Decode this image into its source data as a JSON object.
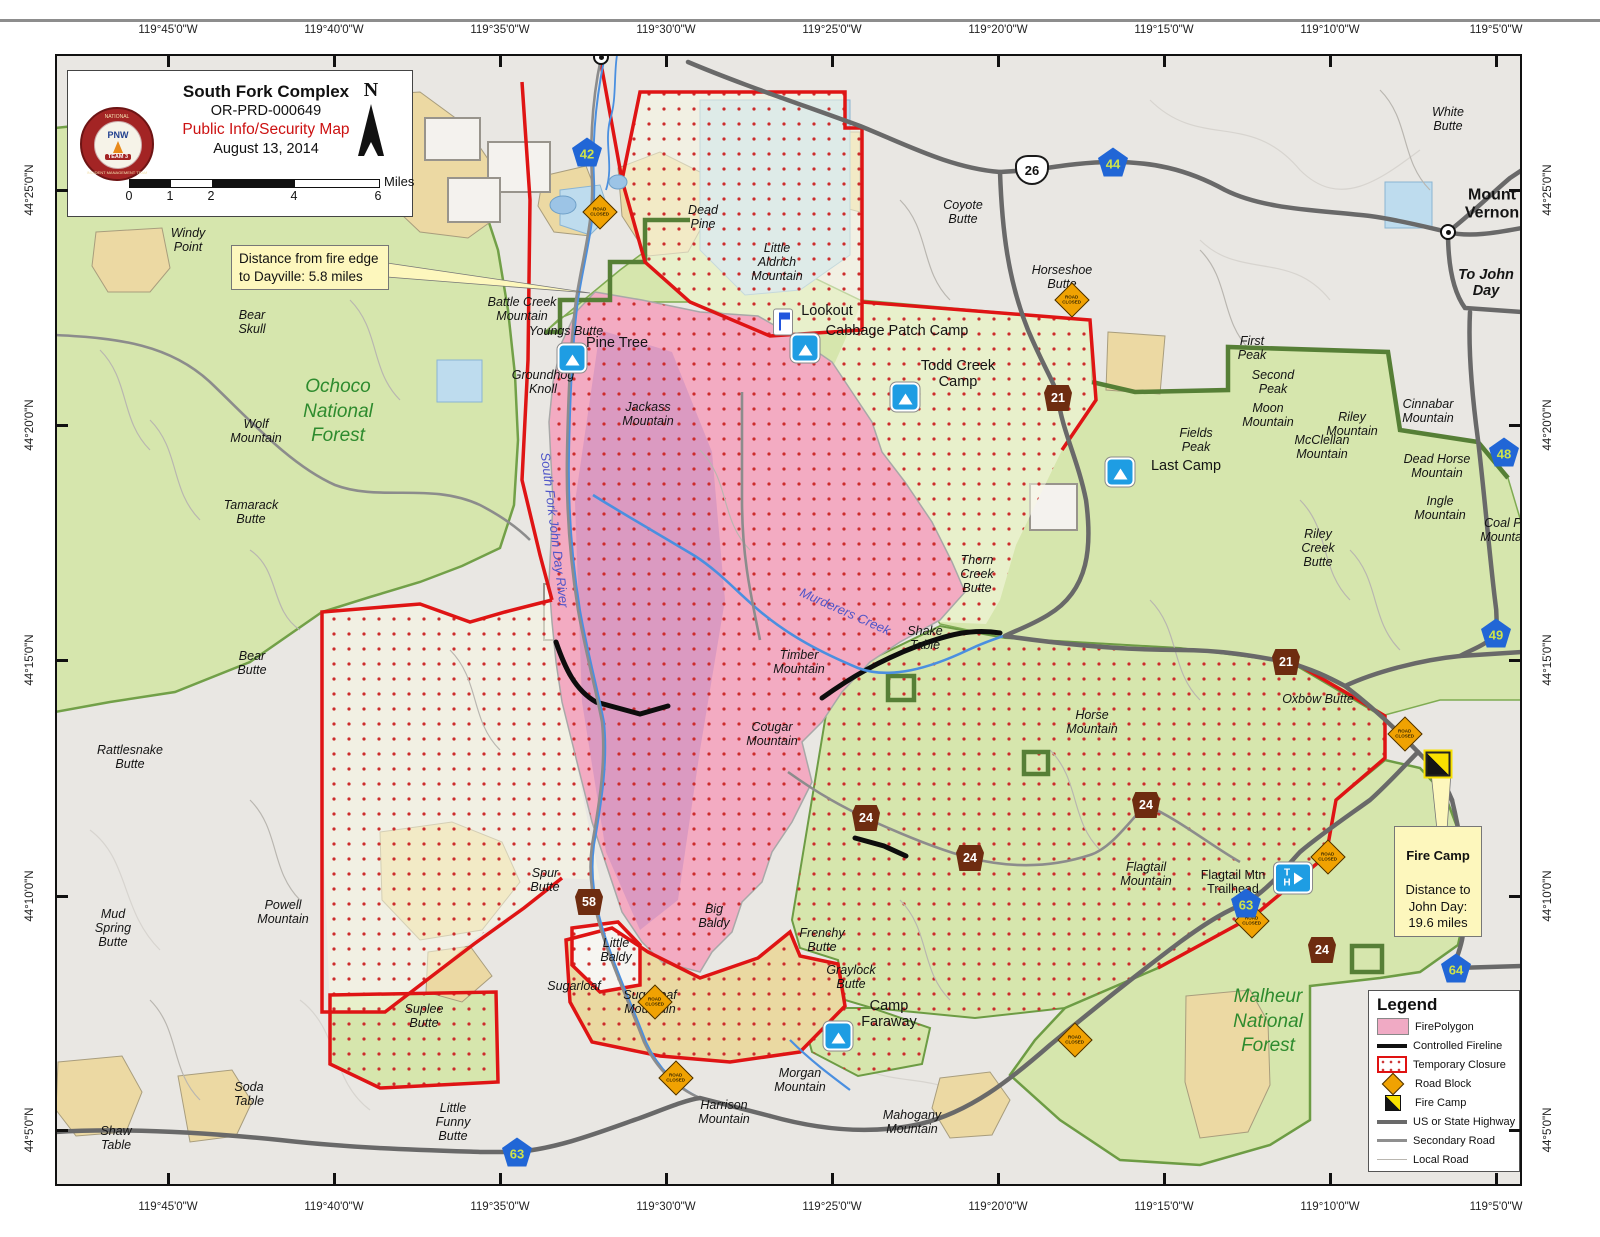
{
  "title_block": {
    "incident_name": "South Fork Complex",
    "incident_number": "OR-PRD-000649",
    "map_type": "Public Info/Security Map",
    "date": "August 13, 2014",
    "north_label": "N",
    "scale_units": "Miles",
    "scale_ticks": [
      "0",
      "1",
      "2",
      "4",
      "6"
    ],
    "logo": {
      "ring_top": "NATIONAL",
      "ring_bottom": "INCIDENT MANAGEMENT TEAM",
      "center": "PNW",
      "banner": "TEAM 3"
    }
  },
  "callouts": {
    "dayville": "Distance from fire edge\nto Dayville:  5.8 miles",
    "fire_camp_title": "Fire Camp",
    "fire_camp_body": "Distance to\nJohn Day:\n19.6 miles"
  },
  "legend": {
    "title": "Legend",
    "items": [
      "FirePolygon",
      "Controlled Fireline",
      "Temporary Closure",
      "Road Block",
      "Fire Camp",
      "US or State Highway",
      "Secondary Road",
      "Local Road"
    ]
  },
  "icon_text": {
    "trailhead": "T\nH",
    "roadblock": "ROAD\nCLOSED"
  },
  "colors": {
    "fire_polygon": "#f3abc2",
    "closure_border": "#e01212",
    "forest_green": "#d6e6ad",
    "highway_blue_shield": "#2166d6",
    "forest_route_brown": "#6e2c10",
    "callout_yellow": "#fdf7bd"
  },
  "coordinates": {
    "top": [
      {
        "t": "119°45'0\"W",
        "x": 168
      },
      {
        "t": "119°40'0\"W",
        "x": 334
      },
      {
        "t": "119°35'0\"W",
        "x": 500
      },
      {
        "t": "119°30'0\"W",
        "x": 666
      },
      {
        "t": "119°25'0\"W",
        "x": 832
      },
      {
        "t": "119°20'0\"W",
        "x": 998
      },
      {
        "t": "119°15'0\"W",
        "x": 1164
      },
      {
        "t": "119°10'0\"W",
        "x": 1330
      },
      {
        "t": "119°5'0\"W",
        "x": 1496
      }
    ],
    "bottom": [
      {
        "t": "119°45'0\"W",
        "x": 168
      },
      {
        "t": "119°40'0\"W",
        "x": 334
      },
      {
        "t": "119°35'0\"W",
        "x": 500
      },
      {
        "t": "119°30'0\"W",
        "x": 666
      },
      {
        "t": "119°25'0\"W",
        "x": 832
      },
      {
        "t": "119°20'0\"W",
        "x": 998
      },
      {
        "t": "119°15'0\"W",
        "x": 1164
      },
      {
        "t": "119°10'0\"W",
        "x": 1330
      },
      {
        "t": "119°5'0\"W",
        "x": 1496
      }
    ],
    "left": [
      {
        "t": "44°25'0\"N",
        "y": 190
      },
      {
        "t": "44°20'0\"N",
        "y": 425
      },
      {
        "t": "44°15'0\"N",
        "y": 660
      },
      {
        "t": "44°10'0\"N",
        "y": 896
      },
      {
        "t": "44°5'0\"N",
        "y": 1130
      }
    ],
    "right": [
      {
        "t": "44°25'0\"N",
        "y": 190
      },
      {
        "t": "44°20'0\"N",
        "y": 425
      },
      {
        "t": "44°15'0\"N",
        "y": 660
      },
      {
        "t": "44°10'0\"N",
        "y": 896
      },
      {
        "t": "44°5'0\"N",
        "y": 1130
      }
    ]
  },
  "map": {
    "labels": [
      {
        "t": "White\nButte",
        "x": 1448,
        "y": 119,
        "cls": "place"
      },
      {
        "t": "Mount\nVernon",
        "x": 1492,
        "y": 204,
        "cls": "town"
      },
      {
        "t": "To John\nDay",
        "x": 1486,
        "y": 283,
        "cls": "town-it"
      },
      {
        "t": "Coyote\nButte",
        "x": 963,
        "y": 212,
        "cls": "place"
      },
      {
        "t": "Horseshoe\nButte",
        "x": 1062,
        "y": 277,
        "cls": "place"
      },
      {
        "t": "Windy\nPoint",
        "x": 188,
        "y": 240,
        "cls": "place"
      },
      {
        "t": "Bear\nSkull",
        "x": 252,
        "y": 322,
        "cls": "place"
      },
      {
        "t": "Battle Creek\nMountain",
        "x": 522,
        "y": 309,
        "cls": "place"
      },
      {
        "t": "Youngs Butte",
        "x": 566,
        "y": 331,
        "cls": "place"
      },
      {
        "t": "Pine Tree",
        "x": 617,
        "y": 343,
        "cls": "camp"
      },
      {
        "t": "Groundhog\nKnoll",
        "x": 543,
        "y": 382,
        "cls": "place"
      },
      {
        "t": "Ochoco\nNational\nForest",
        "x": 338,
        "y": 412,
        "cls": "forest"
      },
      {
        "t": "Wolf\nMountain",
        "x": 256,
        "y": 431,
        "cls": "place"
      },
      {
        "t": "Tamarack\nButte",
        "x": 251,
        "y": 512,
        "cls": "place"
      },
      {
        "t": "Dead\nPine",
        "x": 703,
        "y": 217,
        "cls": "place"
      },
      {
        "t": "Little\nAldrich\nMountain",
        "x": 777,
        "y": 262,
        "cls": "place"
      },
      {
        "t": "Lookout",
        "x": 827,
        "y": 311,
        "cls": "camp"
      },
      {
        "t": "Cabbage Patch Camp",
        "x": 897,
        "y": 331,
        "cls": "camp"
      },
      {
        "t": "Todd Creek\nCamp",
        "x": 958,
        "y": 374,
        "cls": "camp"
      },
      {
        "t": "Jackass\nMountain",
        "x": 648,
        "y": 414,
        "cls": "place"
      },
      {
        "t": "First\nPeak",
        "x": 1252,
        "y": 348,
        "cls": "place"
      },
      {
        "t": "Second\nPeak",
        "x": 1273,
        "y": 382,
        "cls": "place"
      },
      {
        "t": "Moon\nMountain",
        "x": 1268,
        "y": 415,
        "cls": "place"
      },
      {
        "t": "Fields\nPeak",
        "x": 1196,
        "y": 440,
        "cls": "place"
      },
      {
        "t": "Last Camp",
        "x": 1186,
        "y": 466,
        "cls": "camp"
      },
      {
        "t": "Riley\nMountain",
        "x": 1352,
        "y": 424,
        "cls": "place"
      },
      {
        "t": "Cinnabar\nMountain",
        "x": 1428,
        "y": 411,
        "cls": "place"
      },
      {
        "t": "McClellan\nMountain",
        "x": 1322,
        "y": 447,
        "cls": "place"
      },
      {
        "t": "Dead Horse\nMountain",
        "x": 1437,
        "y": 466,
        "cls": "place"
      },
      {
        "t": "Ingle\nMountain",
        "x": 1440,
        "y": 508,
        "cls": "place"
      },
      {
        "t": "Coal Pit\nMountain",
        "x": 1506,
        "y": 530,
        "cls": "place"
      },
      {
        "t": "Riley\nCreek\nButte",
        "x": 1318,
        "y": 548,
        "cls": "place"
      },
      {
        "t": "Thorn\nCreek\nButte",
        "x": 977,
        "y": 574,
        "cls": "place"
      },
      {
        "t": "Shake\nTable",
        "x": 925,
        "y": 638,
        "cls": "place"
      },
      {
        "t": "Timber\nMountain",
        "x": 799,
        "y": 662,
        "cls": "place"
      },
      {
        "t": "Cougar\nMountain",
        "x": 772,
        "y": 734,
        "cls": "place"
      },
      {
        "t": "Bear\nButte",
        "x": 252,
        "y": 663,
        "cls": "place"
      },
      {
        "t": "Rattlesnake\nButte",
        "x": 130,
        "y": 757,
        "cls": "place"
      },
      {
        "t": "Horse\nMountain",
        "x": 1092,
        "y": 722,
        "cls": "place"
      },
      {
        "t": "Oxbow Butte",
        "x": 1318,
        "y": 699,
        "cls": "place"
      },
      {
        "t": "Mud\nSpring\nButte",
        "x": 113,
        "y": 928,
        "cls": "place"
      },
      {
        "t": "Powell\nMountain",
        "x": 283,
        "y": 912,
        "cls": "place"
      },
      {
        "t": "Spur\nButte",
        "x": 545,
        "y": 880,
        "cls": "place"
      },
      {
        "t": "Big\nBaldy",
        "x": 714,
        "y": 916,
        "cls": "place"
      },
      {
        "t": "Little\nBaldy",
        "x": 616,
        "y": 950,
        "cls": "place"
      },
      {
        "t": "Sugarloaf",
        "x": 574,
        "y": 986,
        "cls": "place"
      },
      {
        "t": "Sugarloaf\nMountain",
        "x": 650,
        "y": 1002,
        "cls": "place"
      },
      {
        "t": "Frenchy\nButte",
        "x": 822,
        "y": 940,
        "cls": "place"
      },
      {
        "t": "Graylock\nButte",
        "x": 851,
        "y": 977,
        "cls": "place"
      },
      {
        "t": "Camp\nFaraway",
        "x": 889,
        "y": 1014,
        "cls": "camp"
      },
      {
        "t": "Flagtail\nMountain",
        "x": 1146,
        "y": 874,
        "cls": "place"
      },
      {
        "t": "Flagtail Mtn\nTrailhead",
        "x": 1233,
        "y": 882,
        "cls": "plain"
      },
      {
        "t": "Malheur\nNational\nForest",
        "x": 1268,
        "y": 1022,
        "cls": "forest"
      },
      {
        "t": "Suplee\nButte",
        "x": 424,
        "y": 1016,
        "cls": "place"
      },
      {
        "t": "Soda\nTable",
        "x": 249,
        "y": 1094,
        "cls": "place"
      },
      {
        "t": "Shaw\nTable",
        "x": 116,
        "y": 1138,
        "cls": "place"
      },
      {
        "t": "Little\nFunny\nButte",
        "x": 453,
        "y": 1122,
        "cls": "place"
      },
      {
        "t": "Morgan\nMountain",
        "x": 800,
        "y": 1080,
        "cls": "place"
      },
      {
        "t": "Harrison\nMountain",
        "x": 724,
        "y": 1112,
        "cls": "place"
      },
      {
        "t": "Mahogany\nMountain",
        "x": 912,
        "y": 1122,
        "cls": "place"
      },
      {
        "t": "Murderers Creek",
        "x": 845,
        "y": 612,
        "cls": "creek",
        "rot": 24
      },
      {
        "t": "South Fork John Day River",
        "x": 554,
        "y": 530,
        "cls": "creek",
        "rot": 83
      }
    ],
    "shields": [
      {
        "k": "blue",
        "n": "42",
        "x": 587,
        "y": 152
      },
      {
        "k": "us",
        "n": "26",
        "x": 1032,
        "y": 170
      },
      {
        "k": "blue",
        "n": "44",
        "x": 1113,
        "y": 162
      },
      {
        "k": "blue",
        "n": "48",
        "x": 1504,
        "y": 452
      },
      {
        "k": "blue",
        "n": "49",
        "x": 1496,
        "y": 633
      },
      {
        "k": "brown",
        "n": "21",
        "x": 1058,
        "y": 398
      },
      {
        "k": "brown",
        "n": "21",
        "x": 1286,
        "y": 662
      },
      {
        "k": "brown",
        "n": "24",
        "x": 1146,
        "y": 805
      },
      {
        "k": "brown",
        "n": "24",
        "x": 866,
        "y": 818
      },
      {
        "k": "brown",
        "n": "24",
        "x": 970,
        "y": 858
      },
      {
        "k": "brown",
        "n": "24",
        "x": 1322,
        "y": 950
      },
      {
        "k": "brown",
        "n": "58",
        "x": 589,
        "y": 902
      },
      {
        "k": "blue",
        "n": "63",
        "x": 1246,
        "y": 903
      },
      {
        "k": "blue",
        "n": "63",
        "x": 517,
        "y": 1152
      },
      {
        "k": "blue",
        "n": "64",
        "x": 1456,
        "y": 968
      }
    ],
    "icons": [
      {
        "k": "camp",
        "x": 572,
        "y": 358
      },
      {
        "k": "camp",
        "x": 805,
        "y": 348
      },
      {
        "k": "camp",
        "x": 905,
        "y": 397
      },
      {
        "k": "camp",
        "x": 1120,
        "y": 472
      },
      {
        "k": "camp",
        "x": 838,
        "y": 1036
      },
      {
        "k": "flag",
        "x": 783,
        "y": 322
      },
      {
        "k": "th",
        "x": 1293,
        "y": 878
      },
      {
        "k": "firecamp",
        "x": 1438,
        "y": 764
      },
      {
        "k": "roadblock",
        "x": 600,
        "y": 212
      },
      {
        "k": "roadblock",
        "x": 1072,
        "y": 300
      },
      {
        "k": "roadblock",
        "x": 1405,
        "y": 734
      },
      {
        "k": "roadblock",
        "x": 1328,
        "y": 857
      },
      {
        "k": "roadblock",
        "x": 1252,
        "y": 921
      },
      {
        "k": "roadblock",
        "x": 655,
        "y": 1002
      },
      {
        "k": "roadblock",
        "x": 676,
        "y": 1078
      },
      {
        "k": "roadblock",
        "x": 1075,
        "y": 1040
      },
      {
        "k": "town",
        "x": 601,
        "y": 57
      },
      {
        "k": "town",
        "x": 1448,
        "y": 232
      }
    ]
  }
}
